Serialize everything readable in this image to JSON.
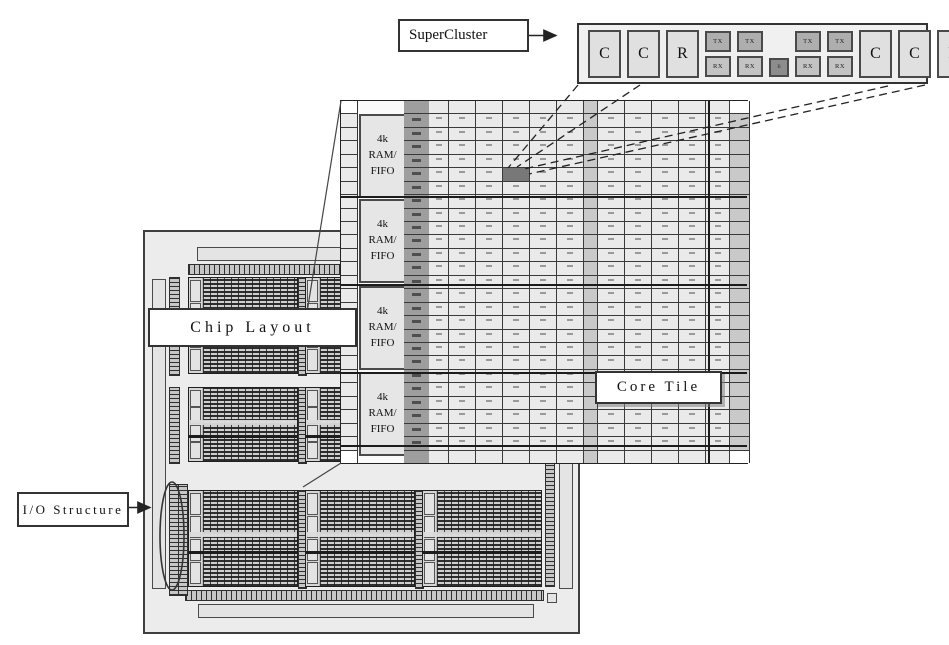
{
  "labels": {
    "supercluster": "SuperCluster",
    "chip_layout": "Chip Layout",
    "io_structure": "I/O Structure",
    "core_tile": "Core Tile"
  },
  "supercluster_detail": {
    "left_blocks": [
      "C",
      "C",
      "R"
    ],
    "right_blocks": [
      "C",
      "C",
      "R"
    ],
    "pairs_per_side": 2,
    "tx_label": "TX",
    "rx_label": "RX",
    "center_label": "B"
  },
  "core_tile": {
    "ram_blocks": [
      {
        "lines": [
          "4k",
          "RAM/",
          "FIFO"
        ]
      },
      {
        "lines": [
          "4k",
          "RAM/",
          "FIFO"
        ]
      },
      {
        "lines": [
          "4k",
          "RAM/",
          "FIFO"
        ]
      },
      {
        "lines": [
          "4k",
          "RAM/",
          "FIFO"
        ]
      }
    ],
    "grid": {
      "rows": 27,
      "cols": 13,
      "highlight_row": 5,
      "highlight_col": 3
    }
  },
  "chip_layout": {
    "tile_rows": 3,
    "tile_cols": 3
  },
  "colors": {
    "ink": "#333333",
    "chip_background": "#ececec",
    "cell_background": "#eaeaea",
    "ram_cell_column": "#9e9e9e",
    "highlighted_cell": "#787878",
    "tx_fill": "#aeaeae",
    "rx_fill": "#c3c3c3",
    "center_block_fill": "#8d8d8d",
    "compute_block_fill": "#e0e0e0"
  }
}
